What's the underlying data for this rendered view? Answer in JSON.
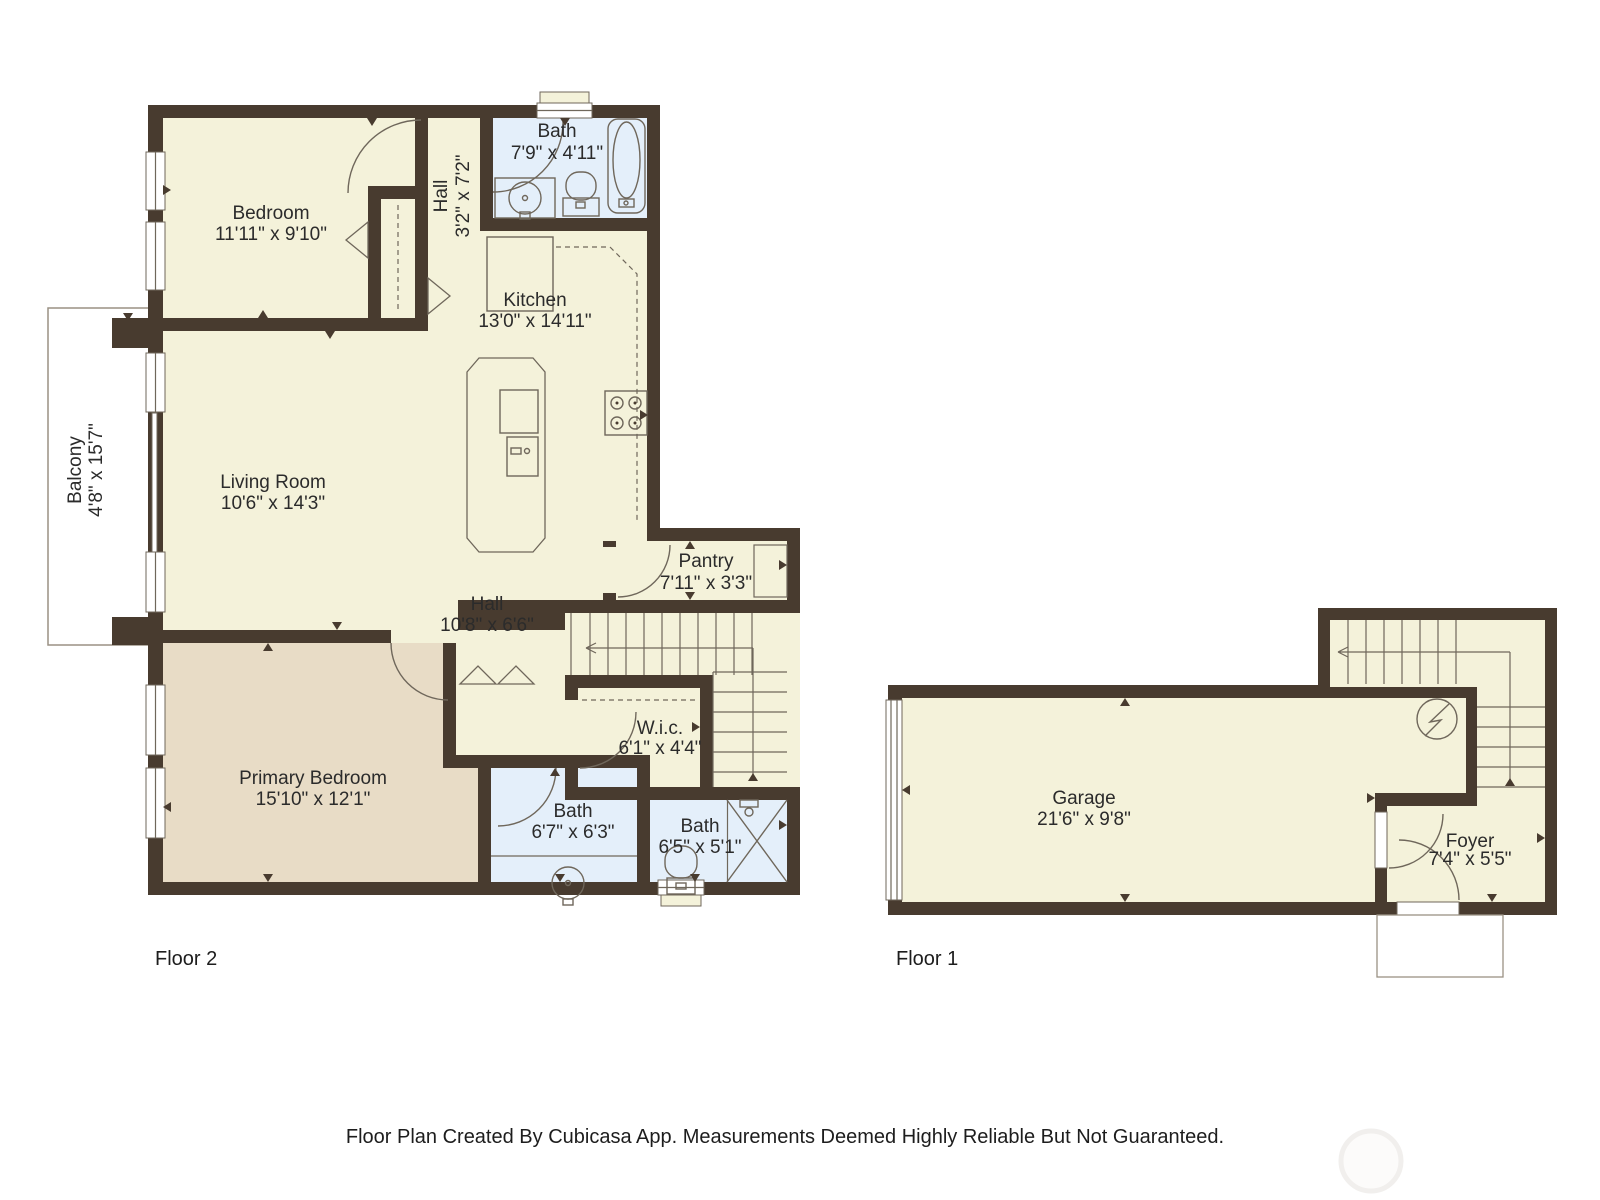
{
  "floor2": {
    "label": "Floor 2",
    "rooms": {
      "bedroom": {
        "name": "Bedroom",
        "dims": "11'11\" x 9'10\""
      },
      "bath_top": {
        "name": "Bath",
        "dims": "7'9\" x 4'11\""
      },
      "hall_upper": {
        "name": "Hall",
        "dims": "3'2\" x 7'2\""
      },
      "kitchen": {
        "name": "Kitchen",
        "dims": "13'0\" x 14'11\""
      },
      "living": {
        "name": "Living Room",
        "dims": "10'6\" x 14'3\""
      },
      "balcony": {
        "name": "Balcony",
        "dims": "4'8\" x 15'7\""
      },
      "pantry": {
        "name": "Pantry",
        "dims": "7'11\" x 3'3\""
      },
      "hall_lower": {
        "name": "Hall",
        "dims": "10'8\" x 6'6\""
      },
      "wic": {
        "name": "W.i.c.",
        "dims": "6'1\" x 4'4\""
      },
      "primary": {
        "name": "Primary Bedroom",
        "dims": "15'10\" x 12'1\""
      },
      "bath_mid": {
        "name": "Bath",
        "dims": "6'7\" x 6'3\""
      },
      "bath_small": {
        "name": "Bath",
        "dims": "6'5\" x 5'1\""
      }
    }
  },
  "floor1": {
    "label": "Floor 1",
    "rooms": {
      "garage": {
        "name": "Garage",
        "dims": "21'6\" x 9'8\""
      },
      "foyer": {
        "name": "Foyer",
        "dims": "7'4\" x 5'5\""
      }
    }
  },
  "footer": "Floor Plan Created By Cubicasa App. Measurements Deemed Highly Reliable But Not Guaranteed.",
  "colors": {
    "wall": "#483b2f",
    "room_fill": "#f4f2da",
    "primary_bedroom_fill": "#e8dcc6",
    "wet_room_fill": "#e4effa",
    "fixture_outline": "#6f675b",
    "text": "#2b2b2b"
  }
}
